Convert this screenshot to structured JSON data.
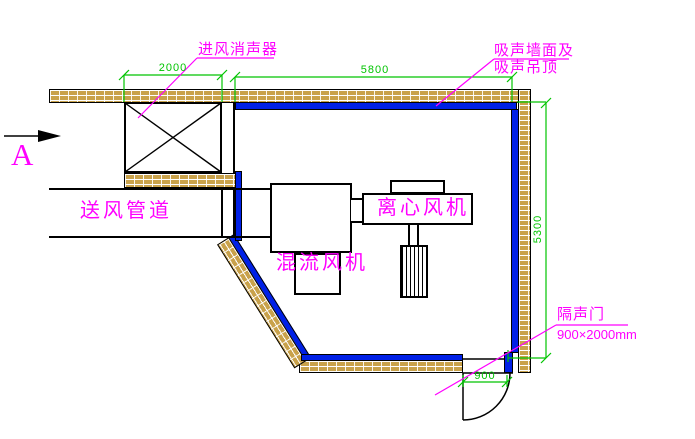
{
  "drawing": {
    "section_marker": "A",
    "labels": {
      "intake_silencer": "进风消声器",
      "absorptive_wall_line1": "吸声墙面及",
      "absorptive_wall_line2": "吸声吊顶",
      "supply_duct": "送风管道",
      "centrifugal_fan": "离心风机",
      "mixed_flow_fan": "混流风机",
      "acoustic_door": "隔声门",
      "acoustic_door_size": "900×2000mm"
    },
    "dimensions": {
      "silencer_length": "2000",
      "room_width": "5800",
      "room_depth": "5300",
      "door_width": "900"
    },
    "colors": {
      "annotation_magenta": "#FF00FF",
      "dimension_green": "#00C400",
      "absorber_blue": "#0020E6",
      "wall_brick_tan": "#C9A24B",
      "outline_black": "#000000"
    }
  }
}
